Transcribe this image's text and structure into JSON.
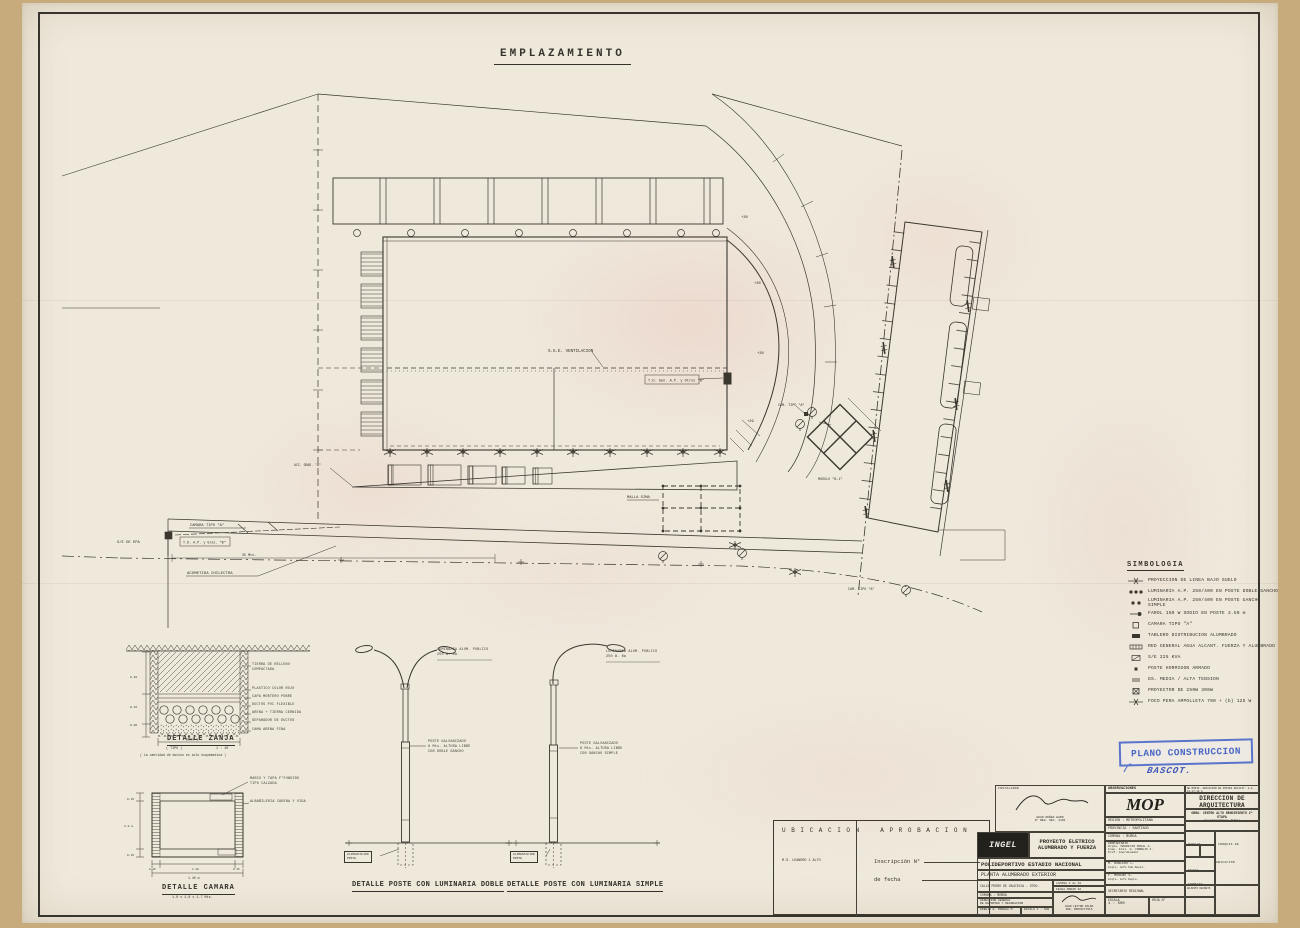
{
  "sheet": {
    "title": "EMPLAZAMIENTO",
    "stamp": {
      "text": "PLANO CONSTRUCCION",
      "sig": "BASCOT."
    }
  },
  "plan": {
    "sge": "S.G.E. VENTILACION",
    "td_b": "T.D. Gen. A.P. y Otros \"B\"",
    "cam1": "CAM. TIPO \"A\"",
    "cam2": "CAMARA TIPO \"A\"",
    "cam3": "CAM. TIPO \"A\"",
    "tdap": "T.D. A.P. y Gral. \"B\"",
    "se": "S/E DE EPA",
    "d35": "35 Mts.",
    "acom": "ACOMETIDA CHILECTRA",
    "malla": "MALLA SIMA",
    "modulo": "MODULO \"B-1\"",
    "acc": "ACC. GRAD. \"A\"",
    "e1": "+30",
    "e2": "+30",
    "e3": "+30",
    "e4": "+29"
  },
  "legend": {
    "title": "SIMBOLOGIA",
    "items": [
      {
        "label": "PROYECCION DE LINEA BAJO SUELO"
      },
      {
        "label": "LUMINARIA A.P. 250/400 EN POSTE DOBLE GANCHO"
      },
      {
        "label": "LUMINARIA A.P. 250/400 EN POSTE GANCHO SIMPLE"
      },
      {
        "label": "FAROL 150 W SODIO EN POSTE 3.50 m"
      },
      {
        "label": "CAMARA TIPO \"A\""
      },
      {
        "label": "TABLERO DISTRIBUCION ALUMBRADO"
      },
      {
        "label": "RED GENERAL AGUA ALCANT. FUERZA Y ALUMBRADO"
      },
      {
        "label": "S/E 225 KVA"
      },
      {
        "label": "POSTE HORMIGON ARMADO"
      },
      {
        "label": "DS. MEDIA / ALTA TENSION"
      },
      {
        "label": "PROYECTOR DE 250W  300W"
      },
      {
        "label": "FOCO PERA AMPOLLETA  700 + (b) 125 W"
      }
    ]
  },
  "details": {
    "zanja": {
      "title": "DETALLE ZANJA",
      "sub_left": "( TIPO )",
      "sub_right": "1 : 10",
      "note": "( La cantidad de ductos es solo esquematica )",
      "callouts": [
        "TIERRA DE RELLENO COMPACTADA",
        "PLASTICO COLOR ROJO",
        "CAPA MORTERO POBRE",
        "DUCTOS PVC FLEXIBLE",
        "ARENA + TIERRA CERNIDA",
        "SEPARADOR DE DUCTOS",
        "CAMA ARENA FINA"
      ],
      "dims": {
        "h1": "0.40",
        "h2": "0.15",
        "h3": "0.05",
        "width": "1.00 m"
      }
    },
    "camara": {
      "title": "DETALLE CAMARA",
      "sub": "1.0 x 1.0 x 1.7 Mts.",
      "callout1a": "MARCO Y TAPA F°FUNDIDO",
      "callout1b": "TIPO CALZADA",
      "callout2": "ALBAÑILERIA CADENA Y VIGA",
      "dims": {
        "l1": "0.15",
        "l2": "1.0 m",
        "l3": "0.15",
        "b1": "0.15",
        "b2": "1.10",
        "b3": "0.15",
        "total": "1.40 m"
      }
    },
    "poste_doble": {
      "title": "DETALLE POSTE CON LUMINARIA DOBLE",
      "lum1": "LUMINARIA ALUM. PUBLICO",
      "lum2": "250 W. Na",
      "poste1": "POSTE GALVANIZADO",
      "poste2": "8 Mts. ALTURA LIBRE",
      "poste3": "CON DOBLE GANCHO",
      "alim1": "ALIMENTACION",
      "alim2": "POSTE"
    },
    "poste_simple": {
      "title": "DETALLE POSTE CON LUMINARIA SIMPLE",
      "lum1": "LUMINARIA ALUM. PUBLICO",
      "lum2": "250 W. Na",
      "poste1": "POSTE GALVANIZADO",
      "poste2": "8 Mts. ALTURA LIBRE",
      "poste3": "CON GANCHO SIMPLE",
      "alim1": "ALIMENTACION",
      "alim2": "POSTE"
    }
  },
  "approval": {
    "ubicacion": "U B I C A C I O N",
    "ubic_note": "M.S. LEANDRO  1 ALTO",
    "aprobacion": "A P R O B A C I O N",
    "insc": "Inscripción  N°",
    "fecha": "de  fecha"
  },
  "titleblock": {
    "instalador": "INSTALADOR",
    "inst_name": "HUGO NUÑEZ HARO",
    "inst_reg": "N° REG. SEC. 1436",
    "logo": "INGEL",
    "proyecto1": "PROYECTO ELETRICO",
    "proyecto2": "ALUMBRADO Y FUERZA",
    "obra1": "POLIDEPORTIVO ESTADIO NACIONAL",
    "obra2": "PLANTA ALUMBRADO EXTERIOR",
    "calle": "CALLE PEDRO DE VALDIVIA - STGO.",
    "lamina": "LAMINA 3 de 52",
    "fecha": "FECHA MARZO 92",
    "comuna_l": "COMUNA : ÑUÑOA",
    "mandante1": "DIRECCION GENERAL",
    "mandante2": "DE DEPORTES Y RECREACION",
    "proy_nom": "JUAN LEYTON PALMA",
    "proy_cargo": "ING. PROYECTISTA",
    "dib_lab": "DIBUJO",
    "dib_val": "E. MORAGA M.",
    "esc_lab": "ESCALA",
    "esc_val": "1 : 500",
    "observaciones": "OBSERVACIONES",
    "obs_text": "SE MODIF. UBICACION DE POSTES SOLICIT. 1-2-14-17-18 A",
    "mop": "MOP",
    "region": "REGION : METROPOLITANA",
    "provincia": "PROVINCIA : SANTIAGO",
    "comuna": "COMUNA : ÑUÑOA",
    "propietario": "PROPIETARIO",
    "prop1": "Arqto. MAURICIO SOVAL A.",
    "prop2": "Insp. Gral. H. CORNEJO I.",
    "prop3": "Prof. Coordinador",
    "firma1": "M. ROBLERO C.",
    "firma1c": "Arqto. Jefe Sub-Depto.",
    "firma2": "F. MORENO S.",
    "firma2c": "Arqto. Jefe Depto.",
    "firma3": "SECRETARIO REGIONAL",
    "esc2_lab": "ESCALA",
    "esc2_val": "1 : 500",
    "hoja": "HOJA N°",
    "dir1": "DIRECCION DE ARQUITECTURA",
    "dir2": "DEPARTAMENTO DE EDIFICACION PUBLICA",
    "obra_l1": "OBRA: CENTRO ALTO RENDIMIENTO 2ª ETAPA",
    "obra_l2": "POLIDEPORTIVO ÑUÑOA",
    "plano_lab": "PLANO",
    "plano_val": "EMPLAZAMIENTO",
    "dibujo2": "DIBUJO",
    "croquis": "CROQUIS DE UBICACION",
    "lamina2": "LAMINA",
    "calco": "CALCO",
    "fecha2": "FECHA",
    "fecha2_val": "MARZO 92",
    "formato_lab": "FORMATO",
    "formato_val": "A - 0",
    "adjunto": "ADJUNTO DECRETO"
  }
}
